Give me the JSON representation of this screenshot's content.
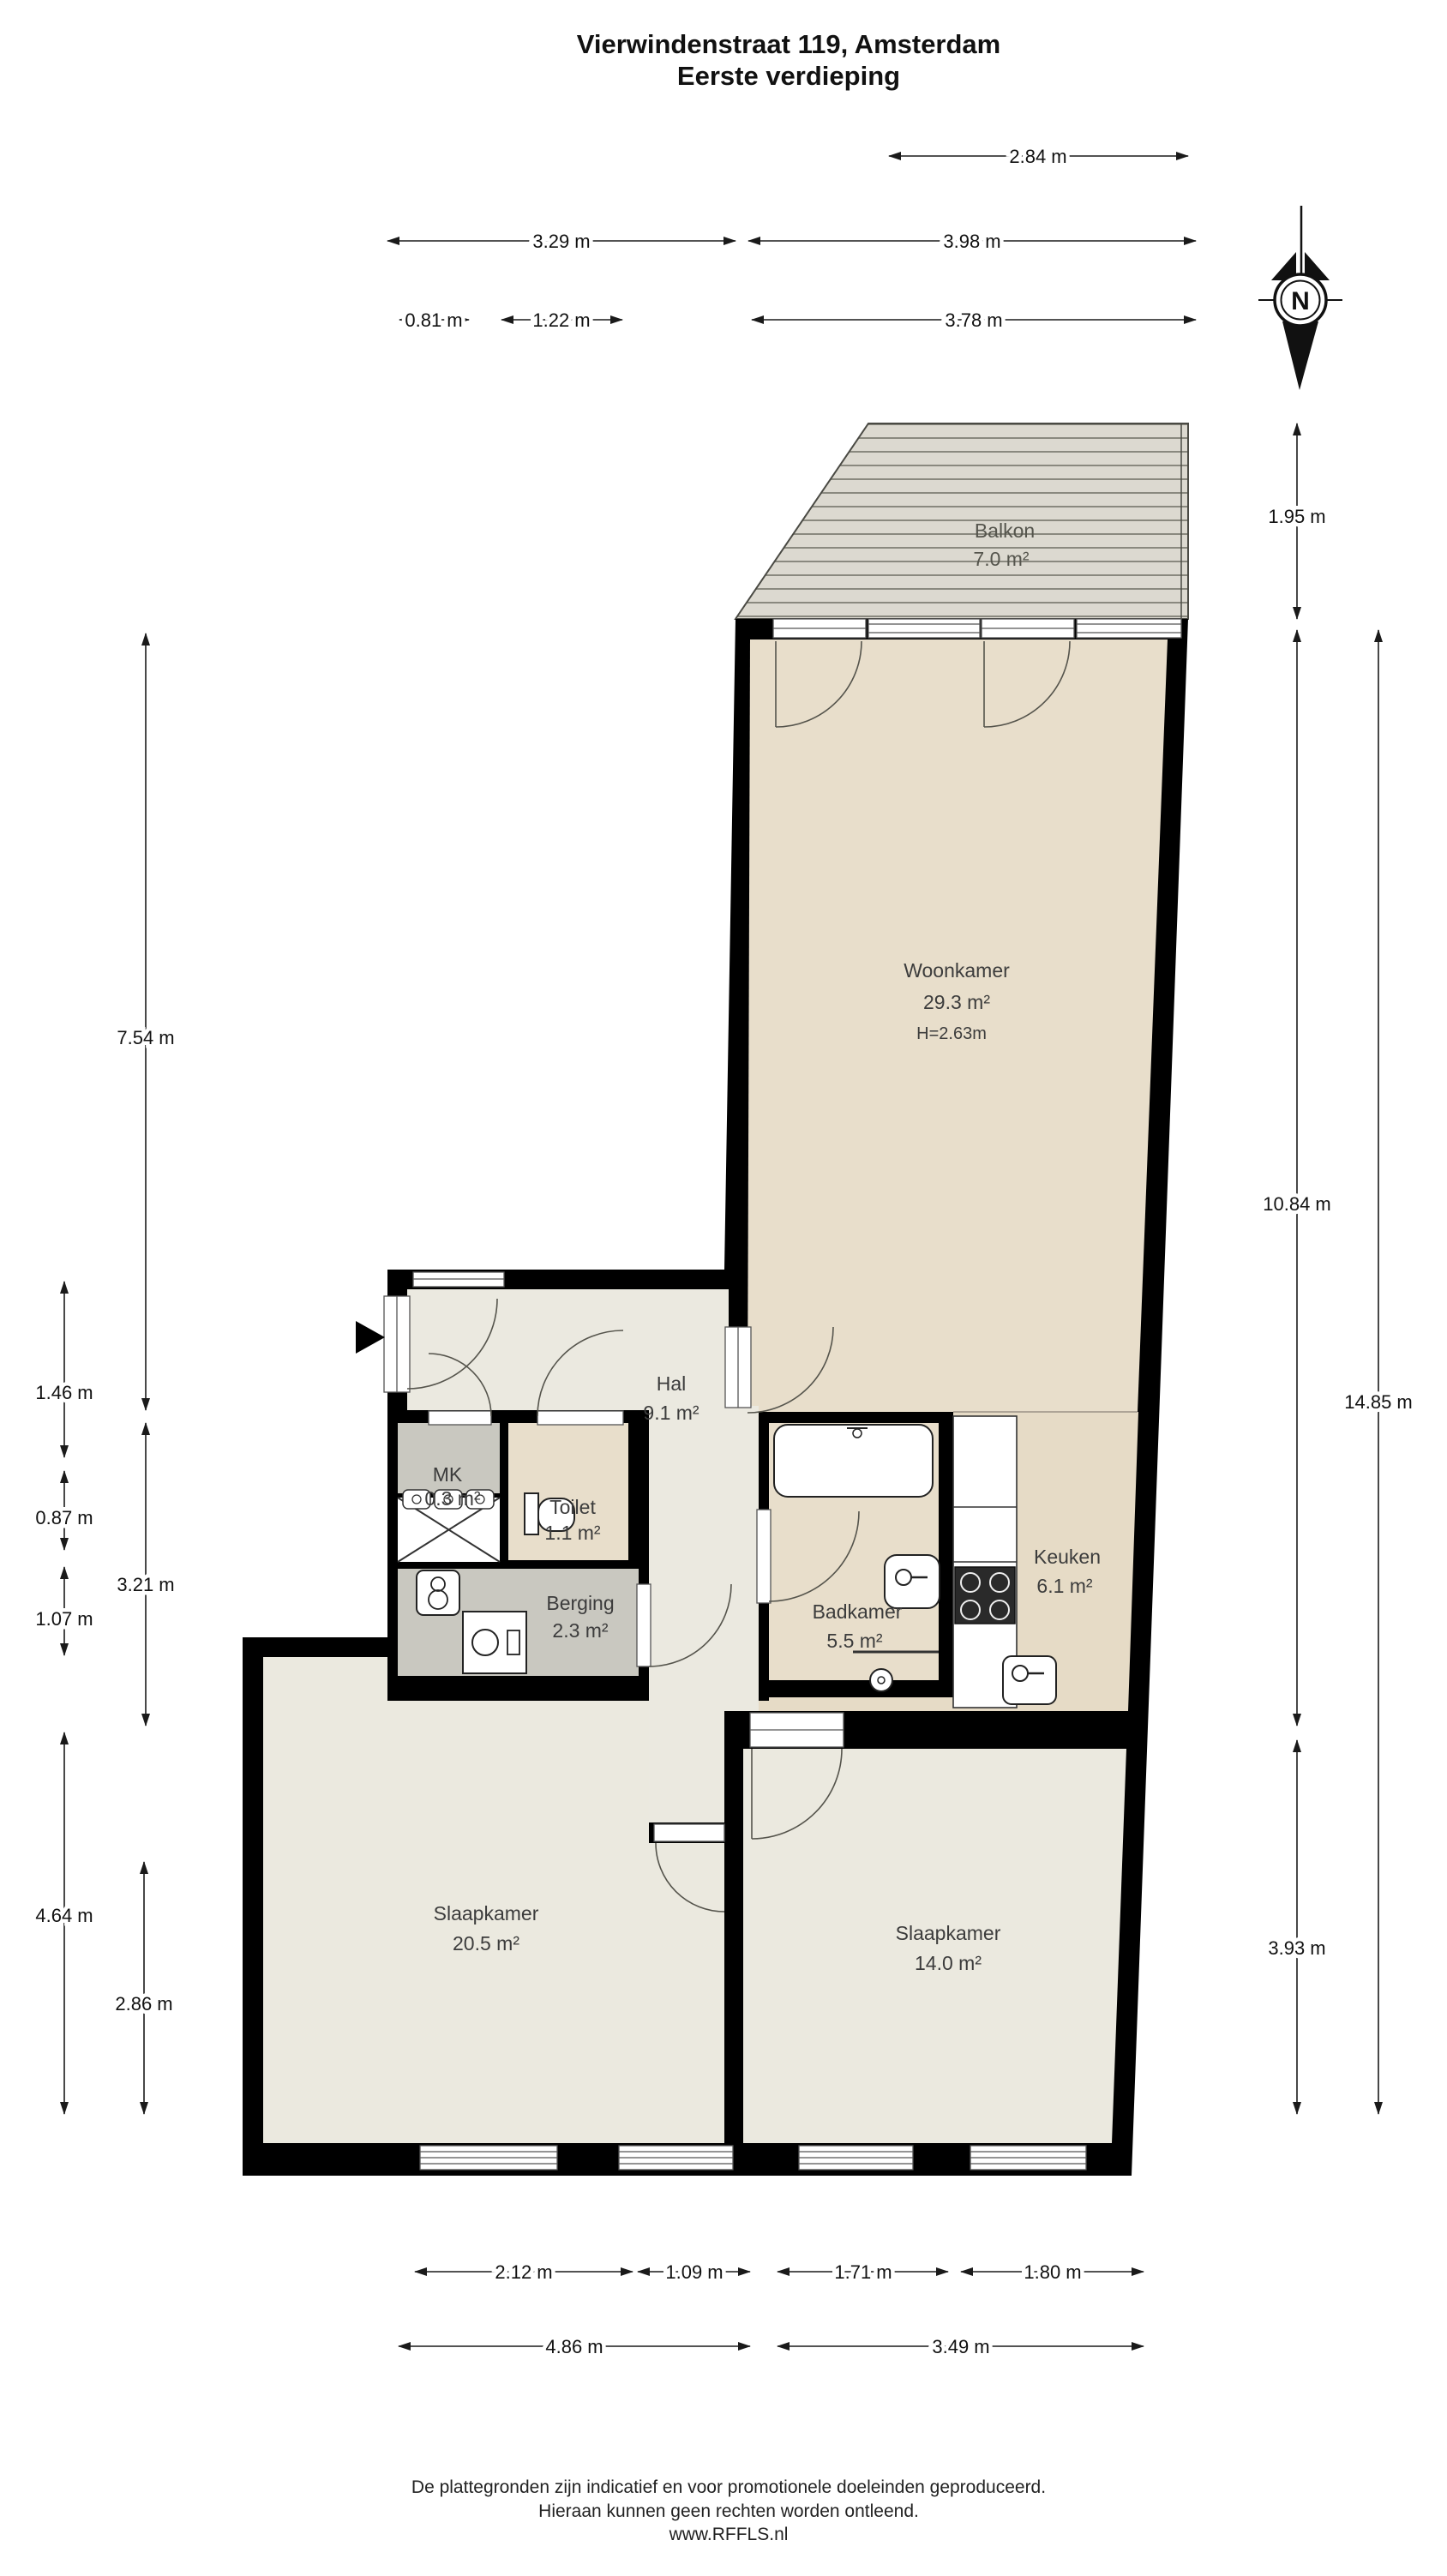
{
  "title": {
    "line1": "Vierwindenstraat 119, Amsterdam",
    "line2": "Eerste verdieping"
  },
  "compass": {
    "label": "N"
  },
  "rooms": {
    "balkon": {
      "name": "Balkon",
      "area": "7.0 m²"
    },
    "woonkamer": {
      "name": "Woonkamer",
      "area": "29.3 m²",
      "ceiling": "H=2.63m"
    },
    "hal": {
      "name": "Hal",
      "area": "9.1 m²"
    },
    "mk": {
      "name": "MK",
      "area": "0.3 m²"
    },
    "toilet": {
      "name": "Toilet",
      "area": "1.1 m²"
    },
    "berging": {
      "name": "Berging",
      "area": "2.3 m²"
    },
    "badkamer": {
      "name": "Badkamer",
      "area": "5.5 m²"
    },
    "keuken": {
      "name": "Keuken",
      "area": "6.1 m²"
    },
    "slaapkamer_links": {
      "name": "Slaapkamer",
      "area": "20.5 m²"
    },
    "slaapkamer_rechts": {
      "name": "Slaapkamer",
      "area": "14.0 m²"
    }
  },
  "dimensions": {
    "top": [
      "2.84 m",
      "3.29 m",
      "3.98 m",
      "0.81 m",
      "1.22 m",
      "3.78 m"
    ],
    "left": [
      "7.54 m",
      "1.46 m",
      "0.87 m",
      "1.07 m",
      "3.21 m",
      "4.64 m",
      "2.86 m"
    ],
    "right": [
      "1.95 m",
      "10.84 m",
      "14.85 m",
      "3.93 m"
    ],
    "bottom": [
      "2.12 m",
      "1.09 m",
      "1.71 m",
      "1.80 m",
      "4.86 m",
      "3.49 m"
    ]
  },
  "footer": {
    "line1": "De plattegronden zijn indicatief en voor promotionele doeleinden geproduceerd.",
    "line2": "Hieraan kunnen geen rechten worden ontleend.",
    "line3": "www.RFFLS.nl"
  },
  "colors": {
    "wall": "#000000",
    "room_beige": "#e8decb",
    "room_light": "#ebe9df",
    "room_gray": "#c9c8c0",
    "balcony": "#dcd9d0",
    "balcony_plank_line": "#8a897f",
    "dimension_text": "#111111"
  }
}
